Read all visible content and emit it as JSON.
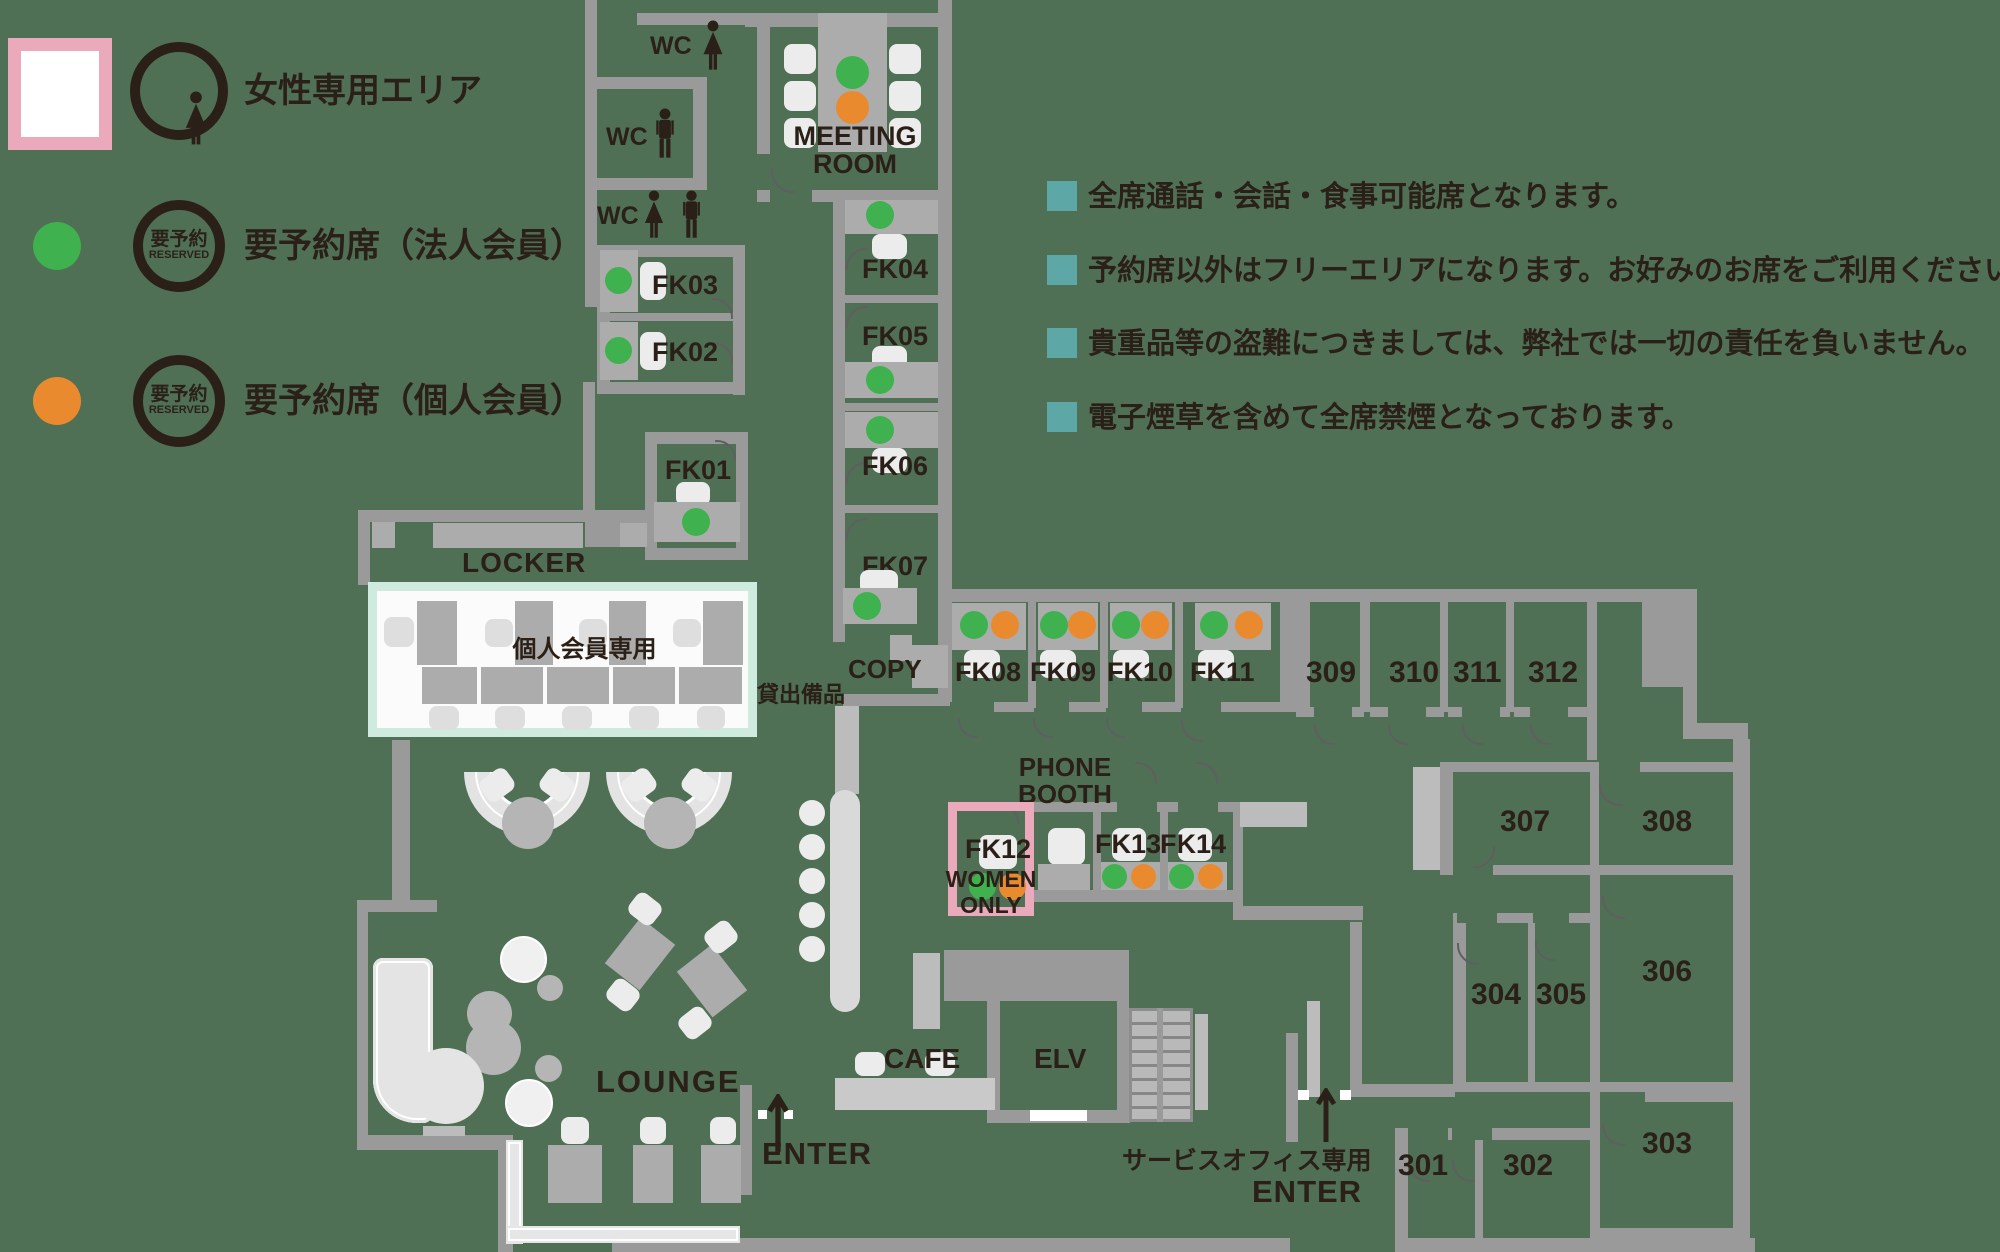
{
  "colors": {
    "bg": "#4f7055",
    "wall": "#9a9a9a",
    "walllight": "#bcbcbc",
    "desk": "#acacac",
    "chair": "#ececec",
    "green": "#3fb14e",
    "orange": "#e98a2f",
    "pink": "#ebaabb",
    "mint": "#cfeade",
    "teal": "#5ea7a7",
    "ink": "#2b2018",
    "paper": "#fbfbfb"
  },
  "legend": {
    "women_area": "女性専用エリア",
    "badge_top": "要予約",
    "badge_bottom": "RESERVED",
    "corporate": "要予約席（法人会員）",
    "individual": "要予約席（個人会員）"
  },
  "notes": [
    "全席通話・会話・食事可能席となります。",
    "予約席以外はフリーエリアになります。お好みのお席をご利用ください。",
    "貴重品等の盗難につきましては、弊社では一切の責任を負いません。",
    "電子煙草を含めて全席禁煙となっております。"
  ],
  "areas": {
    "wc": "WC",
    "meeting_line1": "MEETING",
    "meeting_line2": "ROOM",
    "copy": "COPY",
    "lending": "貸出備品",
    "locker": "LOCKER",
    "locker_note": "個人会員専用",
    "phone_line1": "PHONE",
    "phone_line2": "BOOTH",
    "women": "WOMEN",
    "only": "ONLY",
    "cafe": "CAFE",
    "elv": "ELV",
    "lounge": "LOUNGE",
    "enter": "ENTER",
    "service_office": "サービスオフィス専用"
  },
  "reserved_rooms": {
    "fk01": {
      "label": "FK01",
      "seats": [
        "corporate"
      ]
    },
    "fk02": {
      "label": "FK02",
      "seats": [
        "corporate"
      ]
    },
    "fk03": {
      "label": "FK03",
      "seats": [
        "corporate"
      ]
    },
    "fk04": {
      "label": "FK04",
      "seats": [
        "corporate"
      ]
    },
    "fk05": {
      "label": "FK05",
      "seats": [
        "corporate"
      ]
    },
    "fk06": {
      "label": "FK06",
      "seats": [
        "corporate"
      ]
    },
    "fk07": {
      "label": "FK07",
      "seats": [
        "corporate"
      ]
    },
    "fk08": {
      "label": "FK08",
      "seats": [
        "corporate",
        "individual"
      ]
    },
    "fk09": {
      "label": "FK09",
      "seats": [
        "corporate",
        "individual"
      ]
    },
    "fk10": {
      "label": "FK10",
      "seats": [
        "corporate",
        "individual"
      ]
    },
    "fk11": {
      "label": "FK11",
      "seats": [
        "corporate",
        "individual"
      ]
    },
    "fk12": {
      "label": "FK12",
      "seats": [
        "corporate",
        "individual"
      ],
      "note": "WOMEN ONLY"
    },
    "fk13": {
      "label": "FK13",
      "seats": [
        "corporate",
        "individual"
      ]
    },
    "fk14": {
      "label": "FK14",
      "seats": [
        "corporate",
        "individual"
      ]
    }
  },
  "meeting_room_seats": [
    "corporate",
    "individual"
  ],
  "numbered_rooms": {
    "r301": "301",
    "r302": "302",
    "r303": "303",
    "r304": "304",
    "r305": "305",
    "r306": "306",
    "r307": "307",
    "r308": "308",
    "r309": "309",
    "r310": "310",
    "r311": "311",
    "r312": "312"
  }
}
